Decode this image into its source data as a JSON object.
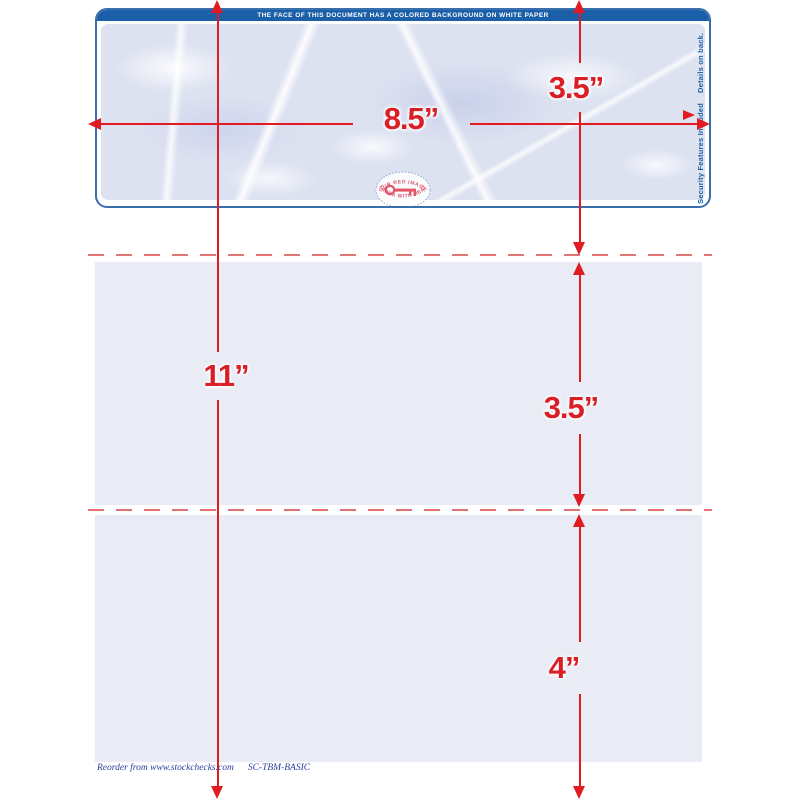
{
  "header_bar": {
    "text": "THE FACE OF THIS DOCUMENT HAS A COLORED BACKGROUND ON WHITE PAPER"
  },
  "check": {
    "key_seal": {
      "top_text": "OUR RED IMAGE",
      "bottom_text": "FADES WITH HEAT",
      "icon": "key-icon"
    },
    "security_note": {
      "left_text": "Security Features Included",
      "right_text": "Details on back.",
      "icon": "padlock-icon"
    }
  },
  "dimensions": {
    "width_label": "8.5”",
    "height_label": "11”",
    "top_section_label": "3.5”",
    "middle_section_label": "3.5”",
    "bottom_section_label": "4”"
  },
  "footer": {
    "reorder_text": "Reorder from www.stockchecks.com",
    "product_code": "SC-TBM-BASIC"
  },
  "colors": {
    "dimension_red": "#e01b22",
    "label_red": "#d81f26",
    "check_border_blue": "#3a6fae",
    "header_blue": "#1b5fa8",
    "marble_base": "#dde2f1",
    "panel_lavender": "#e9ebf5",
    "perforation_pink": "#e57373",
    "footer_blue": "#2b3f9e",
    "key_pink": "#e2566a"
  }
}
